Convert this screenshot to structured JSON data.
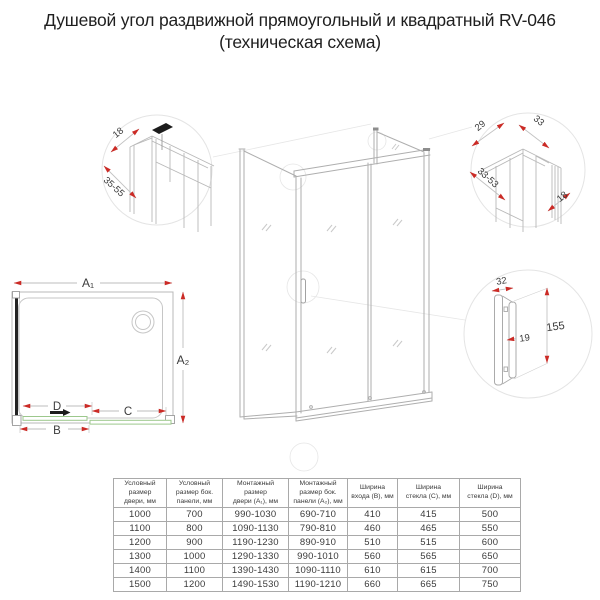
{
  "title": {
    "line1": "Душевой угол раздвижной прямоугольный и квадратный RV-046",
    "line2": "(техническая схема)"
  },
  "colors": {
    "dimension_red": "#cb2b26",
    "glass_green": "#9cc88c",
    "drawing_gray": "#b3b3b3",
    "panel_black": "#1d1d1d"
  },
  "detail_top_left": {
    "dim_profile_depth": "18",
    "dim_adjust_range": "35-55"
  },
  "detail_top_right": {
    "dim_inner": "29",
    "dim_outer": "33",
    "dim_adjust_range": "33-53",
    "dim_depth": "18"
  },
  "detail_handle": {
    "dim_width": "32",
    "dim_gap": "19",
    "dim_height": "155"
  },
  "plan_view": {
    "door_width_label": "A₁",
    "side_depth_label": "A₂",
    "fixed_part_label": "D",
    "glass_c_label": "C",
    "entry_width_label": "B"
  },
  "table": {
    "headers": [
      "Условный\nразмер\nдвери, мм",
      "Условный\nразмер бок.\nпанели, мм",
      "Монтажный\nразмер\nдвери (A₁), мм",
      "Монтажный\nразмер бок.\nпанели (A₂), мм",
      "Ширина\nвхода (B), мм",
      "Ширина\nстекла (C), мм",
      "Ширина\nстекла (D), мм"
    ],
    "rows": [
      [
        "1000",
        "700",
        "990-1030",
        "690-710",
        "410",
        "415",
        "500"
      ],
      [
        "1100",
        "800",
        "1090-1130",
        "790-810",
        "460",
        "465",
        "550"
      ],
      [
        "1200",
        "900",
        "1190-1230",
        "890-910",
        "510",
        "515",
        "600"
      ],
      [
        "1300",
        "1000",
        "1290-1330",
        "990-1010",
        "560",
        "565",
        "650"
      ],
      [
        "1400",
        "1100",
        "1390-1430",
        "1090-1110",
        "610",
        "615",
        "700"
      ],
      [
        "1500",
        "1200",
        "1490-1530",
        "1190-1210",
        "660",
        "665",
        "750"
      ]
    ]
  }
}
